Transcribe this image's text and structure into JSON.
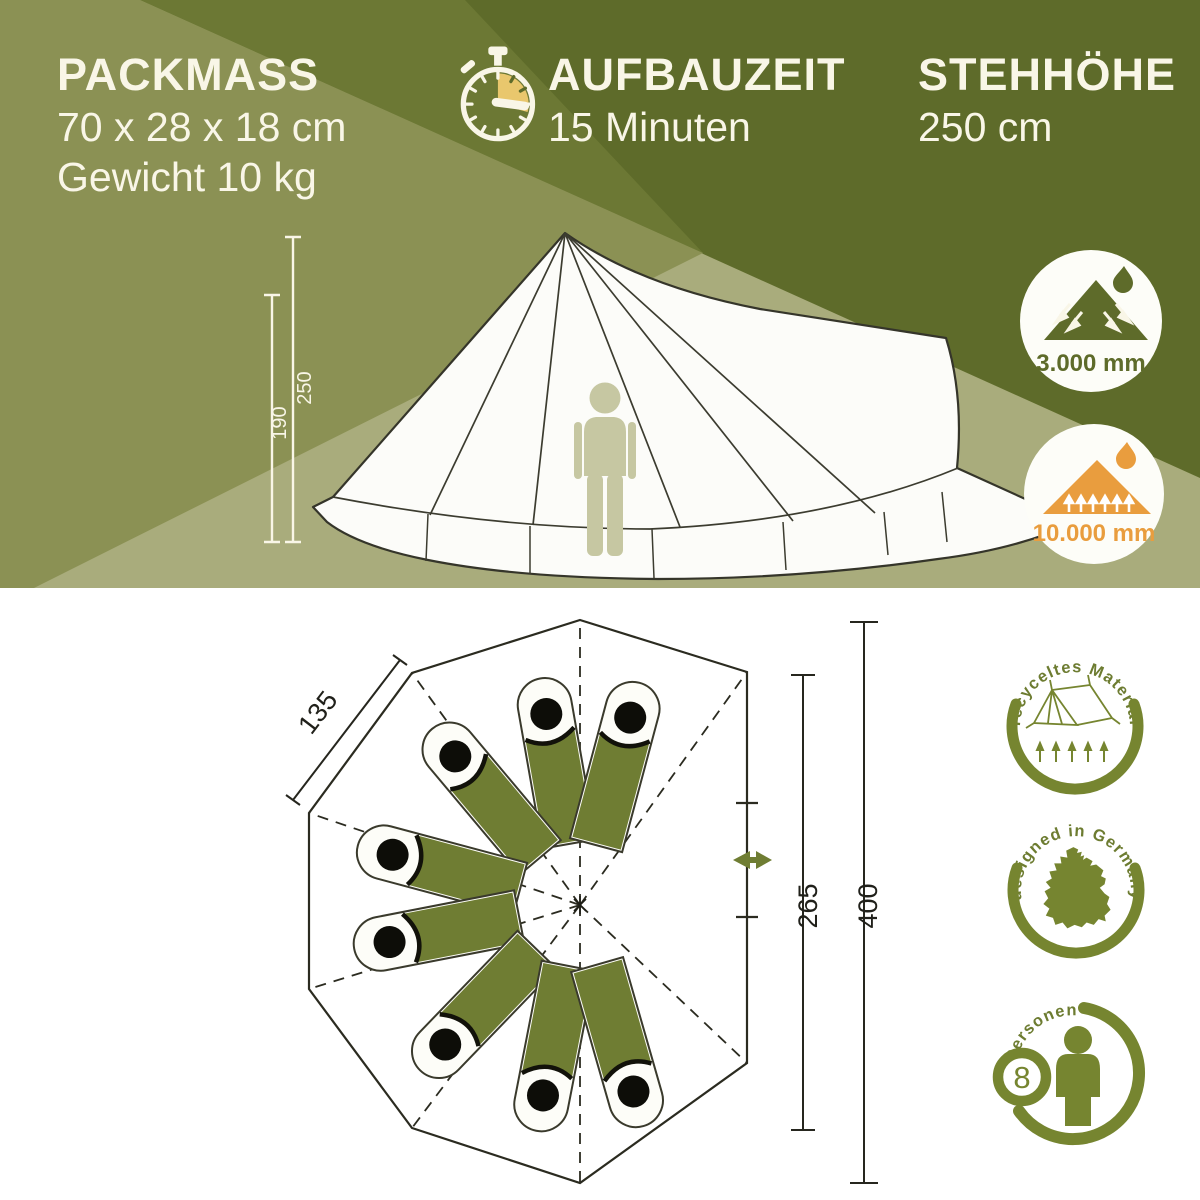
{
  "top_banner": {
    "packmass": {
      "title": "PACKMASS",
      "dimensions": "70 x 28 x 18 cm",
      "weight": "Gewicht 10 kg"
    },
    "aufbauzeit": {
      "title": "AUFBAUZEIT",
      "value": "15 Minuten"
    },
    "stehhoehe": {
      "title": "STEHHÖHE",
      "value": "250 cm"
    },
    "side_view_dims": {
      "outer_height": "250",
      "inner_height": "190"
    },
    "water_column_badges": [
      {
        "value": "3.000 mm"
      },
      {
        "value": "10.000 mm"
      }
    ]
  },
  "floor_plan": {
    "edge_length": "135",
    "door_wall_width": "265",
    "total_width": "400",
    "sleeping_bag_count": 8
  },
  "feature_badges": {
    "recycled": {
      "label": "recyceltes Material"
    },
    "germany": {
      "label": "designed in Germany"
    },
    "persons": {
      "label": "Personen",
      "count": "8"
    }
  },
  "colors": {
    "dark_olive": "#5e6b2a",
    "medium_olive": "#8b9154",
    "light_sage": "#a9ac7c",
    "beam_olive": "#6c7834",
    "cream": "#f9f6e7",
    "accent_yellow": "#e9c76d",
    "accent_orange": "#e99d3e",
    "badge_olive": "#768530",
    "bag_green": "#6f7d33",
    "tent_person": "#c6c7a2"
  }
}
